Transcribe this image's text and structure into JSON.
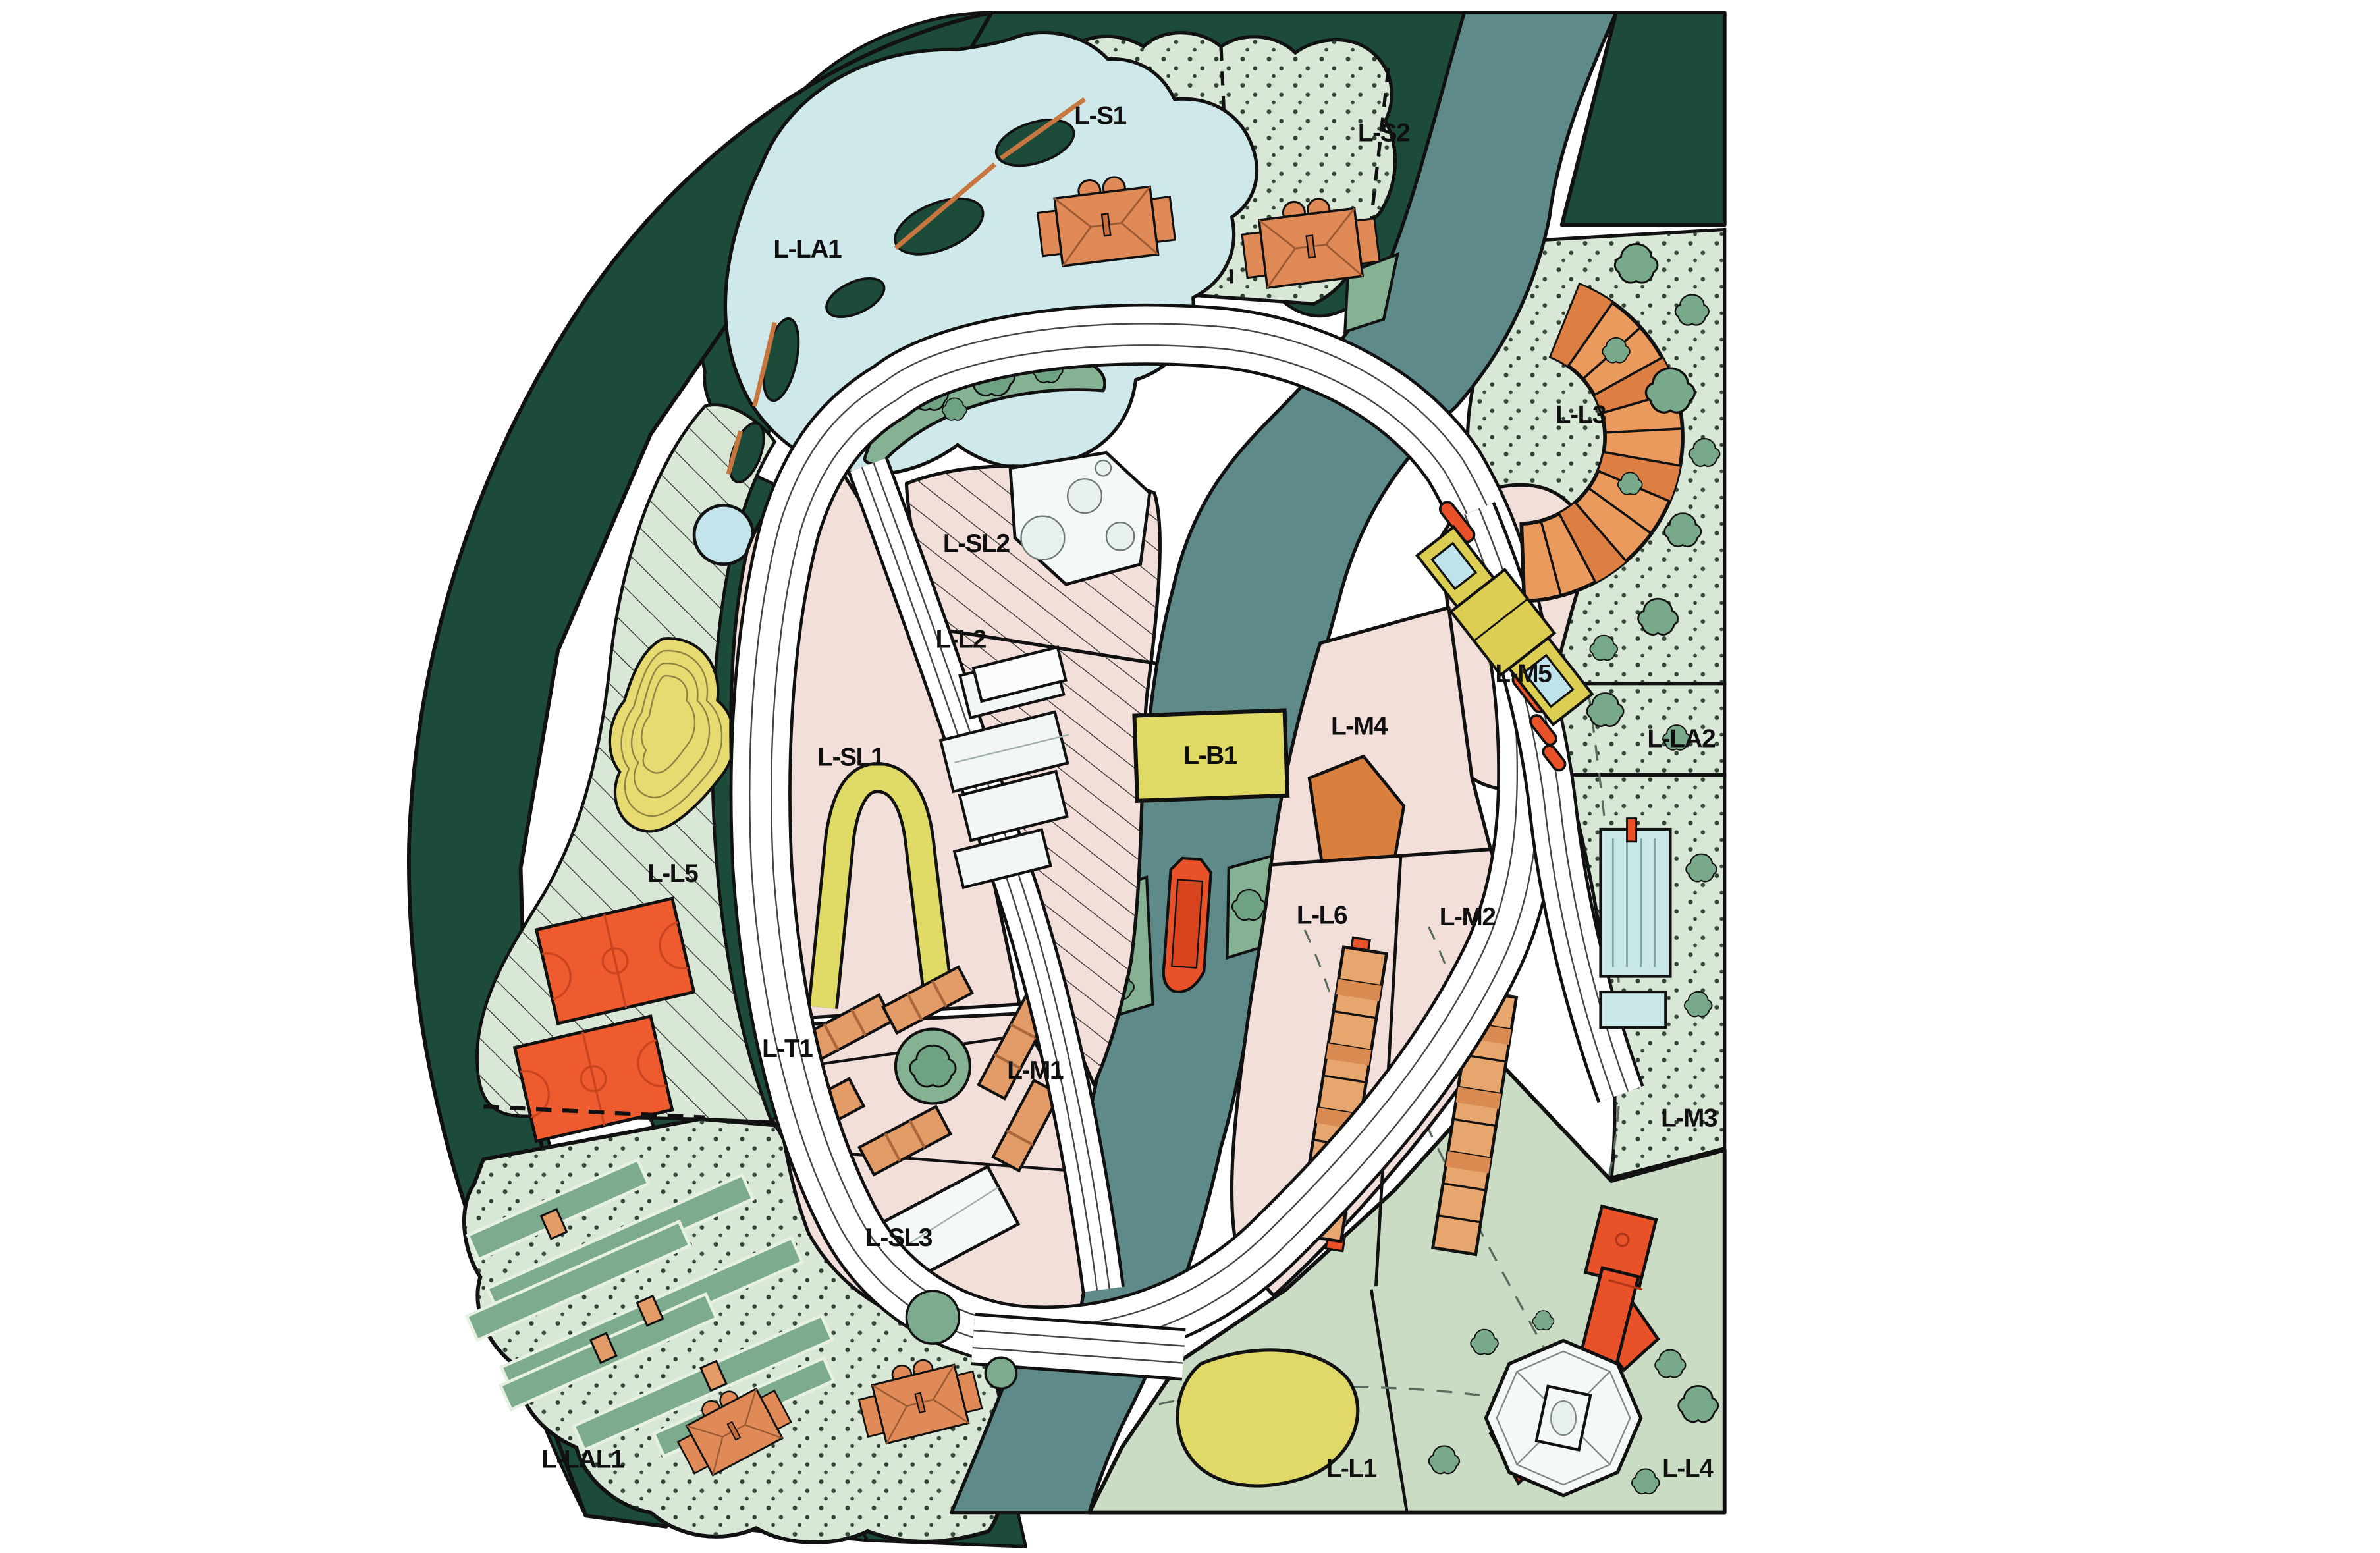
{
  "map": {
    "kind": "landscape-masterplan-site-plan",
    "labels": [
      {
        "id": "l-s1",
        "text": "L-S1"
      },
      {
        "id": "l-s2",
        "text": "L-S2"
      },
      {
        "id": "l-la1",
        "text": "L-LA1"
      },
      {
        "id": "l-l3",
        "text": "L-L3"
      },
      {
        "id": "l-sl2",
        "text": "L-SL2"
      },
      {
        "id": "l-l2",
        "text": "L-L2"
      },
      {
        "id": "l-m5",
        "text": "L-M5"
      },
      {
        "id": "l-m4",
        "text": "L-M4"
      },
      {
        "id": "l-b1",
        "text": "L-B1"
      },
      {
        "id": "l-la2",
        "text": "L-LA2"
      },
      {
        "id": "l-sl1",
        "text": "L-SL1"
      },
      {
        "id": "l-l5",
        "text": "L-L5"
      },
      {
        "id": "l-l6",
        "text": "L-L6"
      },
      {
        "id": "l-m2",
        "text": "L-M2"
      },
      {
        "id": "l-t1",
        "text": "L-T1"
      },
      {
        "id": "l-m1",
        "text": "L-M1"
      },
      {
        "id": "l-m3",
        "text": "L-M3"
      },
      {
        "id": "l-sl3",
        "text": "L-SL3"
      },
      {
        "id": "l-lal1",
        "text": "L-LAL1"
      },
      {
        "id": "l-l1",
        "text": "L-L1"
      },
      {
        "id": "l-l4",
        "text": "L-L4"
      }
    ],
    "colors": {
      "background": "#ffffff",
      "forest_green": "#1C4B3A",
      "parcel_dotted_green": "#D9E8D6",
      "parcel_sage_green": "#CBDCC5",
      "planting_green": "#86B294",
      "tree_green": "#79A98B",
      "lake_blue": "#CFE9EA",
      "pool_blue": "#C9E7E6",
      "river_teal": "#5E8B89",
      "parcel_pink": "#F2DFD9",
      "building_orange": "#E08A57",
      "accent_red_orange": "#E95129",
      "accent_yellow": "#E0DA66",
      "dune_yellow": "#E6DA70",
      "building_white": "#F4F8F6",
      "road_white": "#FFFFFF",
      "outline_black": "#111111"
    }
  }
}
